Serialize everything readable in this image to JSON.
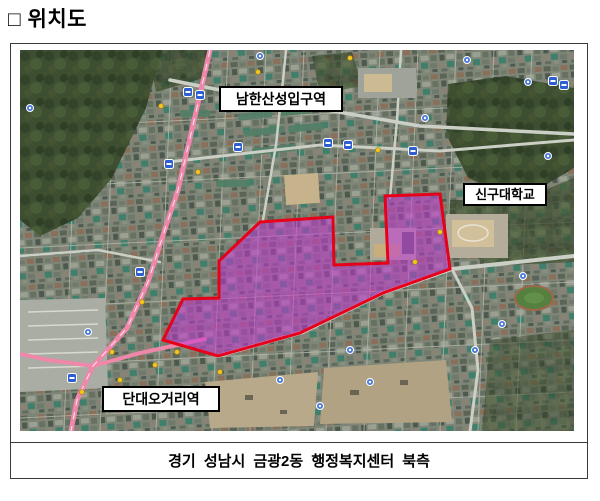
{
  "page": {
    "title": "□ 위치도"
  },
  "figure": {
    "caption": "경기 성남시 금광2동 행정복지센터 북측",
    "map": {
      "type": "satellite-imagery",
      "labels": [
        {
          "id": "namhansanseong-station",
          "text": "남한산성입구역"
        },
        {
          "id": "shingu-university",
          "text": "신구대학교"
        },
        {
          "id": "dandae-ogeori-station",
          "text": "단대오거리역"
        }
      ],
      "highlight_area": {
        "fill_color": "#c336d2",
        "border_color": "#e60019"
      },
      "colors": {
        "main_road_pink": "#ef87ab",
        "transit_marker_blue": "#2e5fd0",
        "forest_green": "#3e4e31"
      }
    }
  }
}
